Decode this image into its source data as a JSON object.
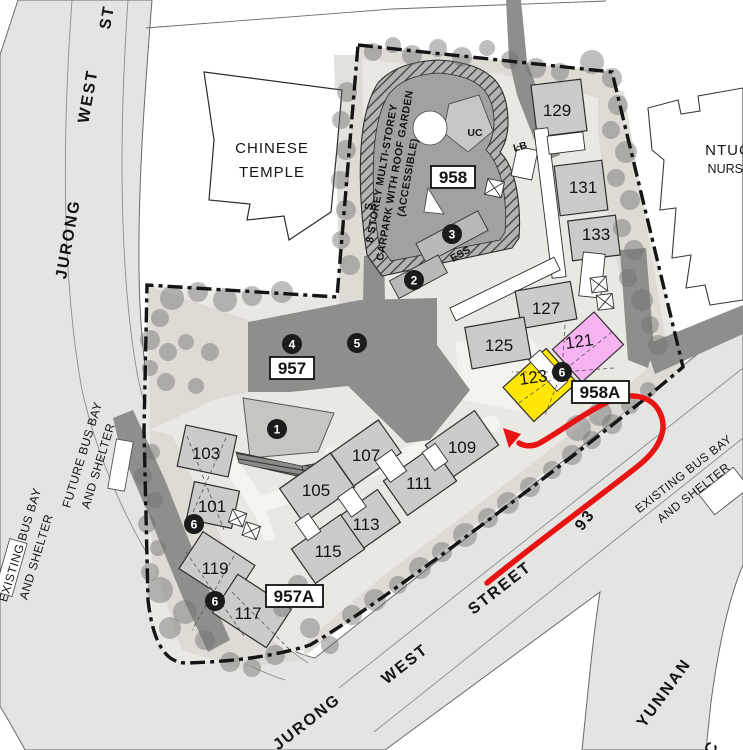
{
  "streets": {
    "top": [
      "JURONG",
      "WEST",
      "ST"
    ],
    "bottom": [
      "JURONG",
      "WEST",
      "STREET",
      "93"
    ],
    "yunnan": "YUNNAN",
    "yunnan_c": "C"
  },
  "bus_bays": {
    "future": [
      "FUTURE BUS BAY",
      "AND SHELTER"
    ],
    "existing_left": [
      "EXISTING BUS BAY",
      "AND SHELTER"
    ],
    "existing_right": [
      "EXISTING BUS BAY",
      "AND SHELTER"
    ]
  },
  "landmarks": {
    "temple_line1": "CHINESE",
    "temple_line2": "TEMPLE",
    "ntuc_line1": "NTUC",
    "ntuc_line2": "NURSERY"
  },
  "carpark": {
    "line1": "8 STOREY MULTI-STOREY",
    "line2": "CARPARK WITH ROOF GARDEN",
    "line3": "(ACCESSIBLE)",
    "uc": "UC",
    "lb": "LB",
    "s": "S",
    "ess": "ESS"
  },
  "precincts": {
    "p957": "957",
    "p958": "958",
    "p957a": "957A",
    "p958a": "958A"
  },
  "blocks": {
    "b101": "101",
    "b103": "103",
    "b105": "105",
    "b107": "107",
    "b109": "109",
    "b111": "111",
    "b113": "113",
    "b115": "115",
    "b117": "117",
    "b119": "119",
    "b121": "121",
    "b123": "123",
    "b125": "125",
    "b127": "127",
    "b129": "129",
    "b131": "131",
    "b133": "133"
  },
  "markers": {
    "playground": "1",
    "m2": "2",
    "m3": "3",
    "m4": "4",
    "m5": "5",
    "m6": "6"
  },
  "colors": {
    "route_red": "#e81414",
    "block_pink": "#f7b2f2",
    "block_yellow": "#ffe607",
    "tree_gray": "#6f6f6f",
    "road_dark": "#8e8e8c",
    "block_gray": "#cbcbc9"
  }
}
